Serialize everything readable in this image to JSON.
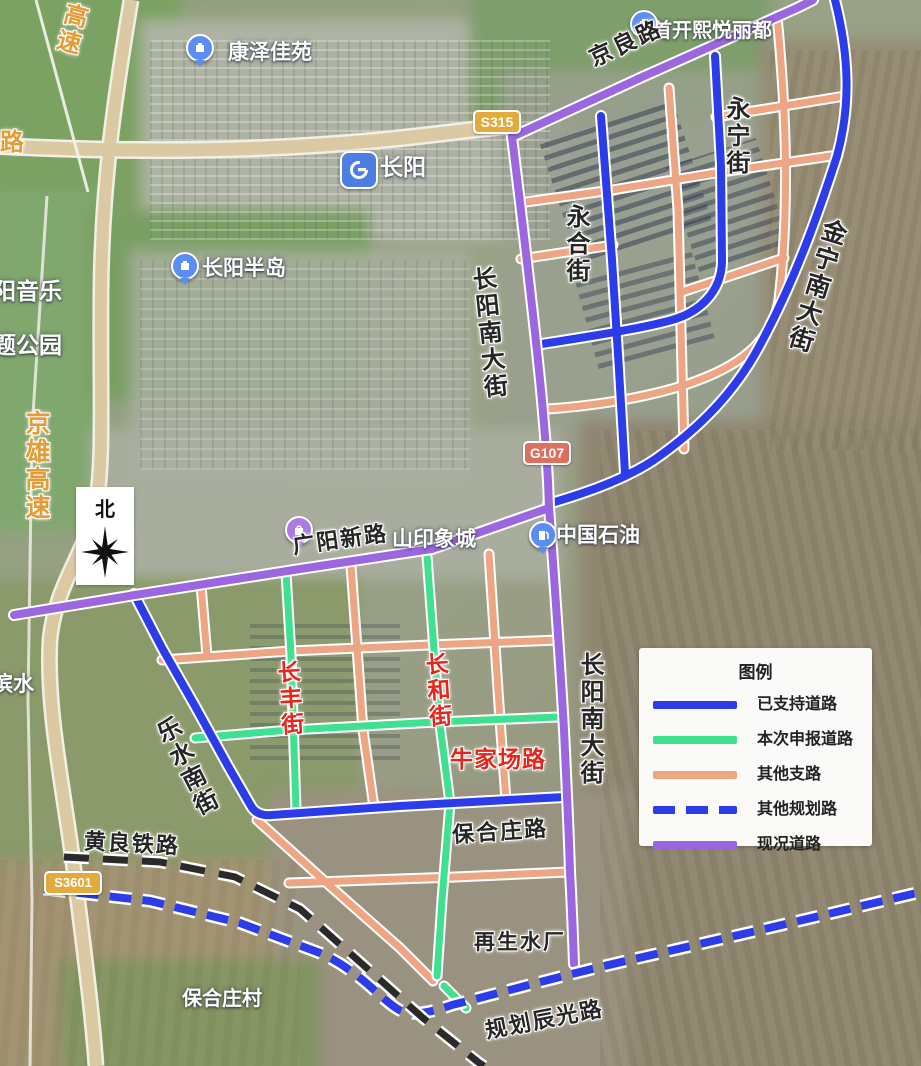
{
  "legend": {
    "title": "图例",
    "items": [
      {
        "label": "已支持道路",
        "style": "blue-solid"
      },
      {
        "label": "本次申报道路",
        "style": "green-solid"
      },
      {
        "label": "其他支路",
        "style": "orange-solid"
      },
      {
        "label": "其他规划路",
        "style": "blue-dashed"
      },
      {
        "label": "现况道路",
        "style": "purple-solid"
      }
    ]
  },
  "compass": {
    "north": "北"
  },
  "badges": {
    "s315": "S315",
    "g107": "G107",
    "s3601": "S3601"
  },
  "places": {
    "kangzejiayuan": "康泽佳苑",
    "shoukai_xiyue": "首开熙悦丽都",
    "changyang_station": "长阳",
    "changyang_peninsula": "长阳半岛",
    "yinxiangcheng": "山印象城",
    "zhongguo_shiyou": "中国石油",
    "binshui": "滨水",
    "yang_yinyue": "阳音乐",
    "ti_gongyuan": "题公园",
    "baohezhuang_village": "保合庄村",
    "zaisheng_shuichang": "再生水厂"
  },
  "streets": {
    "jingliang_road": "京良路",
    "yongning_street": "永宁街",
    "yonghe_street": "永合街",
    "changyangnan_avenue_upper": "长阳南大街",
    "changyangnan_avenue_lower": "长阳南大街",
    "jinningnan_avenue": "金宁南大街",
    "guangyangxin_road": "广阳新路",
    "leshuinan_street": "乐水南街",
    "huangliang_railway": "黄良铁路",
    "baohezhuang_road": "保合庄路",
    "guihua_chenguang_road": "规划辰光路"
  },
  "applied_streets": {
    "changfeng_street": "长丰街",
    "changhe_street": "长和街",
    "niujiachang_road": "牛家场路"
  },
  "expressway": {
    "jingxiong_expressway": "京雄高速",
    "gaosu_partial": "高速",
    "lu_partial": "路"
  },
  "colors": {
    "supported_road": "#2b3ce8",
    "applied_road": "#3fe08f",
    "branch_road": "#eda584",
    "planned_road_dashed": "#2b3ce8",
    "existing_road": "#9b66de",
    "railway": "#2a2a2a",
    "expressway_fill": "#dbc9a4",
    "badge_yellow": "#e3aa3c",
    "badge_red": "#dd6f60",
    "red_label": "#e4261d"
  }
}
